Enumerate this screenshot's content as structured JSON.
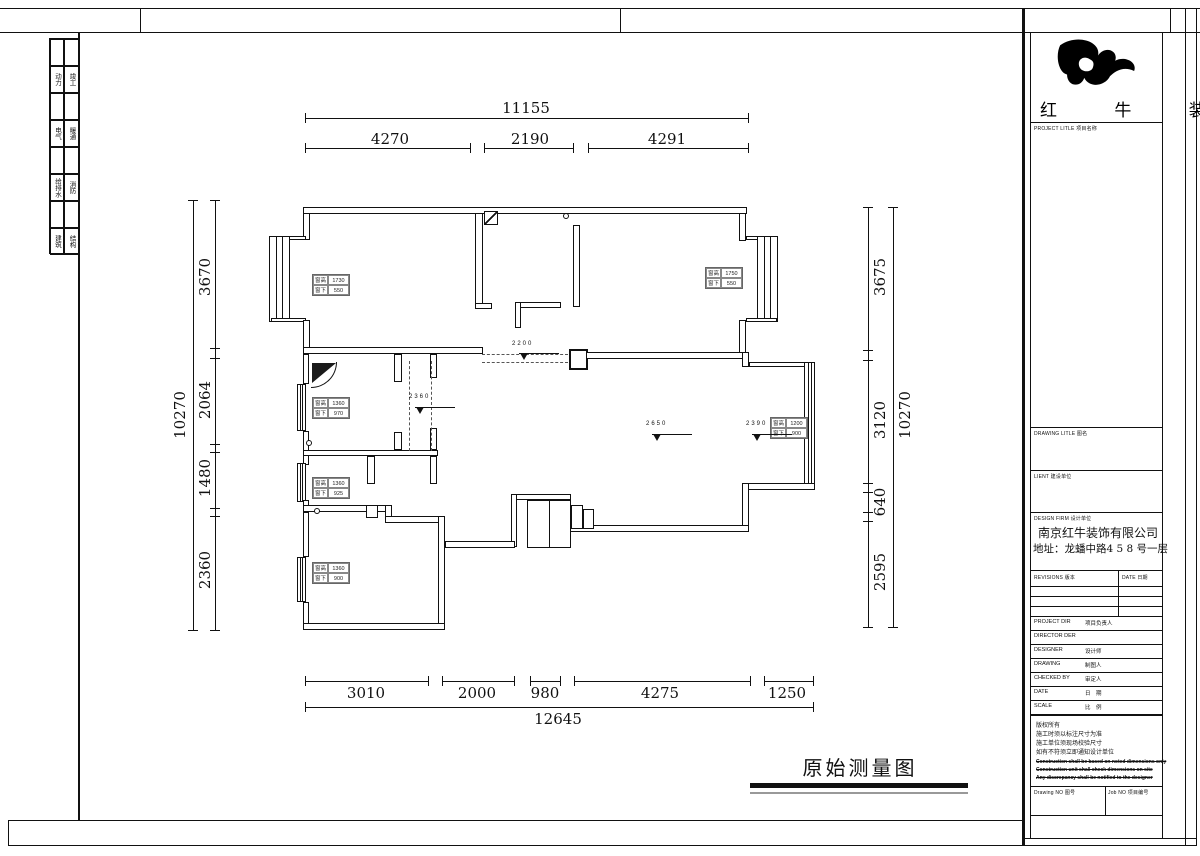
{
  "sheet": {
    "logo_text": "红 牛 装 饰",
    "drawing_title": "原始测量图",
    "frame_rows": [
      {
        "l": "动力",
        "r": "竣工"
      },
      {
        "l": "电气",
        "r": "暖通"
      },
      {
        "l": "给排水",
        "r": "消防"
      },
      {
        "l": "建筑",
        "r": "结构"
      }
    ]
  },
  "title_block": {
    "project_title_label": "PROJECT LITLE  项目名称",
    "drawing_title_label": "DRAWING LITLE  图名",
    "client_label": "LIENT  建设单位",
    "design_firm_label": "DESIGN FIRM  设计单位",
    "firm_name": "南京红牛装饰有限公司",
    "firm_address": "地址：龙蟠中路4 5 8 号一层",
    "revisions_label": "REVISIONS  版本",
    "date_col_label": "DATE 日期",
    "rows": [
      {
        "en": "PROJECT DIR",
        "cn": "项目负责人"
      },
      {
        "en": "DIRECTOR DER",
        "cn": ""
      },
      {
        "en": "DESIGNER",
        "cn": "设计师"
      },
      {
        "en": "DRAWING",
        "cn": "制图人"
      },
      {
        "en": "CHECKED BY",
        "cn": "审定人"
      },
      {
        "en": "DATE",
        "cn": "日　期"
      },
      {
        "en": "SCALE",
        "cn": "比　例"
      }
    ],
    "notice_cn": [
      "版权所有",
      "施工时须以标注尺寸为准",
      "施工单位须现场校验尺寸",
      "如有不符须立即通知设计单位"
    ],
    "notice_en": [
      "Construction shall be based on noted dimensions only",
      "Construction unit shall check dimensions on site",
      "Any discrepancy shall be notified to the designer"
    ],
    "drawing_no_label": "Drawing NO 图号",
    "job_no_label": "Job NO 项目编号"
  },
  "dims": {
    "top": {
      "total": "11155",
      "segments": [
        "4270",
        "2190",
        "4291"
      ]
    },
    "bottom": {
      "total": "12645",
      "segments": [
        "3010",
        "2000",
        "980",
        "4275",
        "1250"
      ]
    },
    "left": {
      "total": "10270",
      "segments": [
        "3670",
        "2064",
        "1480",
        "2360"
      ]
    },
    "right": {
      "total": "10270",
      "segments": [
        "3675",
        "3120",
        "640",
        "2595"
      ]
    }
  },
  "plan": {
    "levels": [
      "2200",
      "2360",
      "2650",
      "2390"
    ],
    "window_tags": [
      {
        "hl": "窗高",
        "h": "1730",
        "sl": "窗下",
        "s": "550"
      },
      {
        "hl": "窗高",
        "h": "1750",
        "sl": "窗下",
        "s": "550"
      },
      {
        "hl": "窗高",
        "h": "1360",
        "sl": "窗下",
        "s": "970"
      },
      {
        "hl": "窗高",
        "h": "1360",
        "sl": "窗下",
        "s": "925"
      },
      {
        "hl": "窗高",
        "h": "1360",
        "sl": "窗下",
        "s": "900"
      },
      {
        "hl": "窗高",
        "h": "1200",
        "sl": "窗下",
        "s": "900"
      }
    ]
  }
}
